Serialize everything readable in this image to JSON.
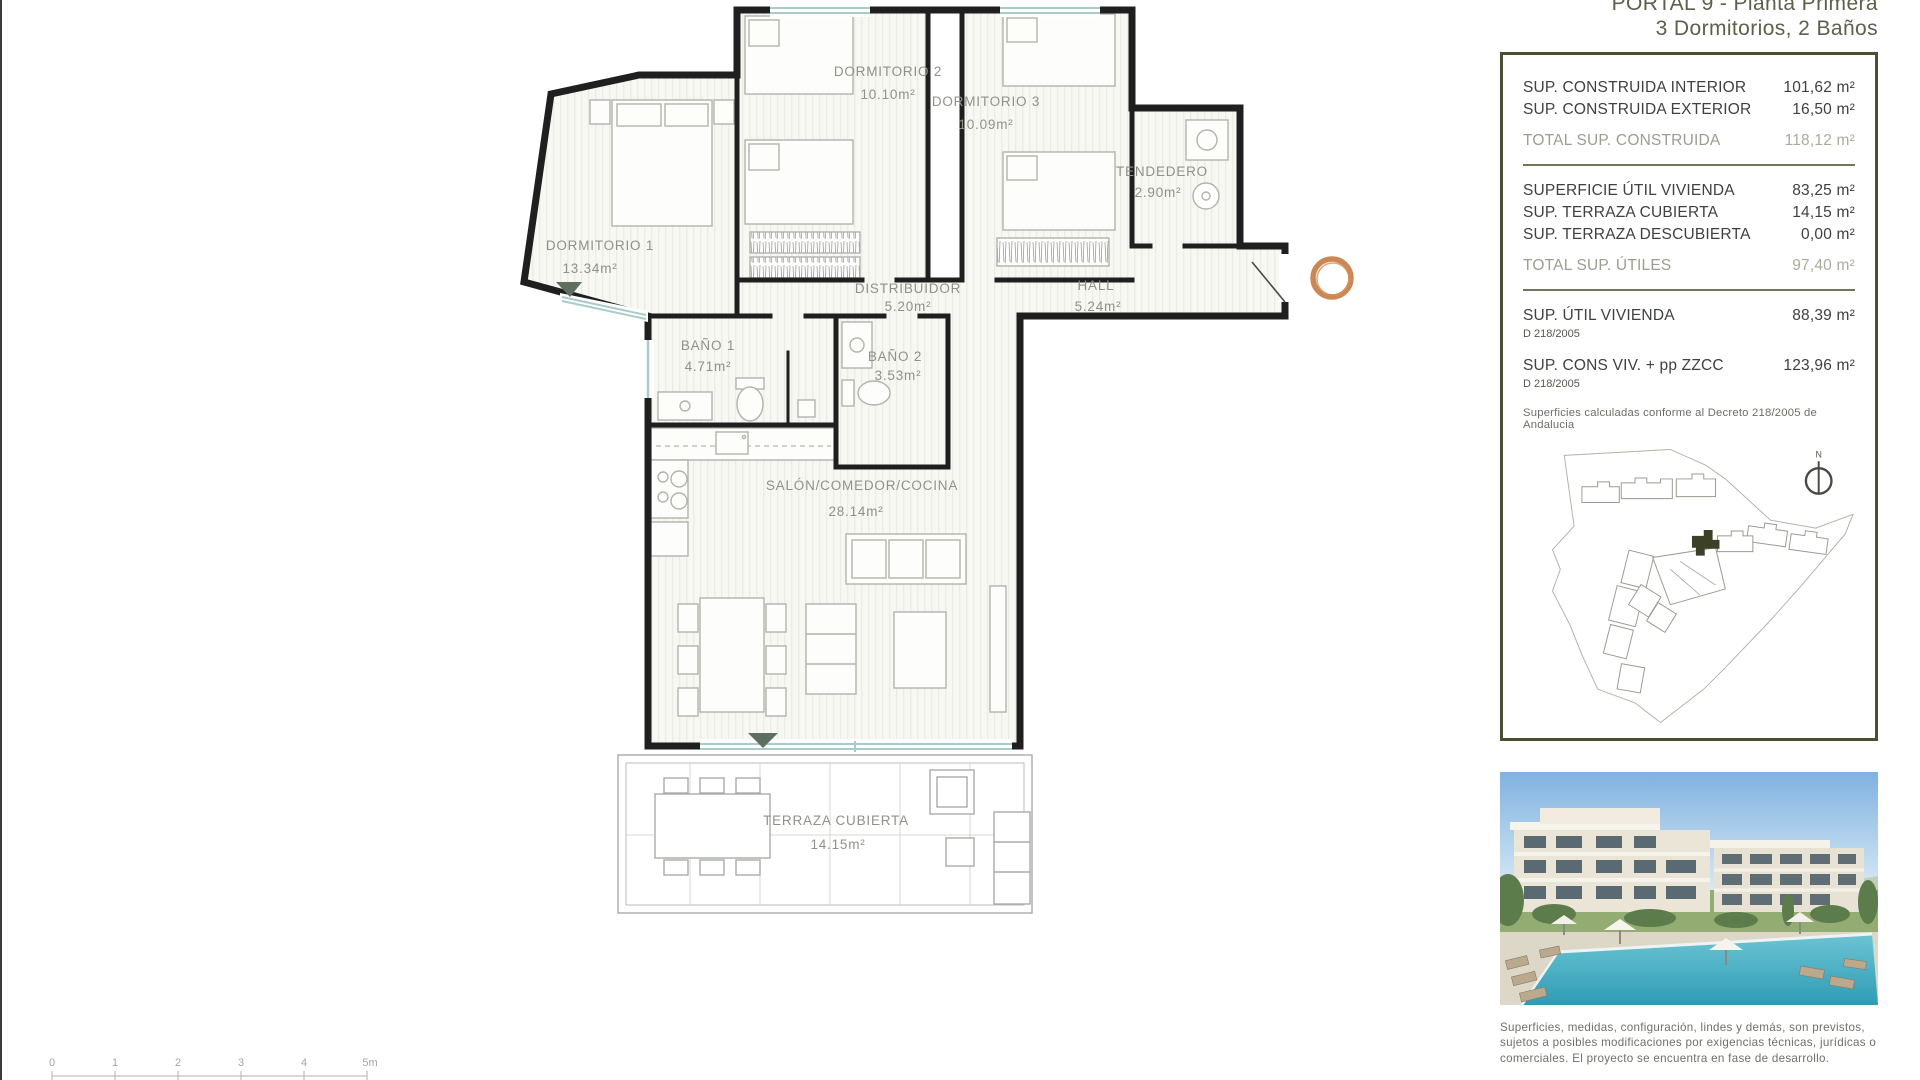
{
  "header": {
    "title_line1": "PORTAL 9 - Planta Primera",
    "title_line2": "3 Dormitorios, 2 Baños"
  },
  "summary_panel": {
    "construida_rows": [
      {
        "label": "SUP. CONSTRUIDA INTERIOR",
        "value": "101,62 m²"
      },
      {
        "label": "SUP. CONSTRUIDA EXTERIOR",
        "value": "16,50 m²"
      }
    ],
    "total_construida": {
      "label": "TOTAL SUP. CONSTRUIDA",
      "value": "118,12 m²"
    },
    "utiles_rows": [
      {
        "label": "SUPERFICIE ÚTIL VIVIENDA",
        "value": "83,25 m²"
      },
      {
        "label": "SUP. TERRAZA CUBIERTA",
        "value": "14,15 m²"
      },
      {
        "label": "SUP. TERRAZA DESCUBIERTA",
        "value": "0,00 m²"
      }
    ],
    "total_utiles": {
      "label": "TOTAL SUP. ÚTILES",
      "value": "97,40 m²"
    },
    "decreto_rows": [
      {
        "label": "SUP. ÚTIL VIVIENDA",
        "sub": "D 218/2005",
        "value": "88,39 m²"
      },
      {
        "label": "SUP. CONS VIV. + pp ZZCC",
        "sub": "D 218/2005",
        "value": "123,96 m²"
      }
    ],
    "note": "Superficies calculadas conforme al Decreto 218/2005 de Andalucia",
    "north_label": "N"
  },
  "floor_plan": {
    "rooms": [
      {
        "name": "DORMITORIO 2",
        "area": "10.10m²"
      },
      {
        "name": "DORMITORIO 3",
        "area": "10.09m²"
      },
      {
        "name": "TENDEDERO",
        "area": "2.90m²"
      },
      {
        "name": "DORMITORIO 1",
        "area": "13.34m²"
      },
      {
        "name": "DISTRIBUIDOR",
        "area": "5.20m²"
      },
      {
        "name": "HALL",
        "area": "5.24m²"
      },
      {
        "name": "BAÑO 1",
        "area": "4.71m²"
      },
      {
        "name": "BAÑO 2",
        "area": "3.53m²"
      },
      {
        "name": "SALÓN/COMEDOR/COCINA",
        "area": "28.14m²"
      },
      {
        "name": "TERRAZA CUBIERTA",
        "area": "14.15m²"
      }
    ],
    "scale_bar": {
      "labels": [
        "0",
        "1",
        "2",
        "3",
        "4",
        "5m"
      ]
    }
  },
  "disclaimer": "Superficies, medidas, configuración, lindes y demás, son previstos, sujetos a posibles modificaciones por exigencias técnicas, jurídicas o comerciales. El proyecto se encuentra en fase de desarrollo.",
  "colors": {
    "accent_ring": "#c87e45",
    "panel_border": "#4b4f33",
    "wall": "#1f1f1f",
    "room_label": "#8f928a",
    "total_text": "#9b9e8f",
    "glazing": "#a9cbc9",
    "door_marker": "#5f6f5f"
  }
}
